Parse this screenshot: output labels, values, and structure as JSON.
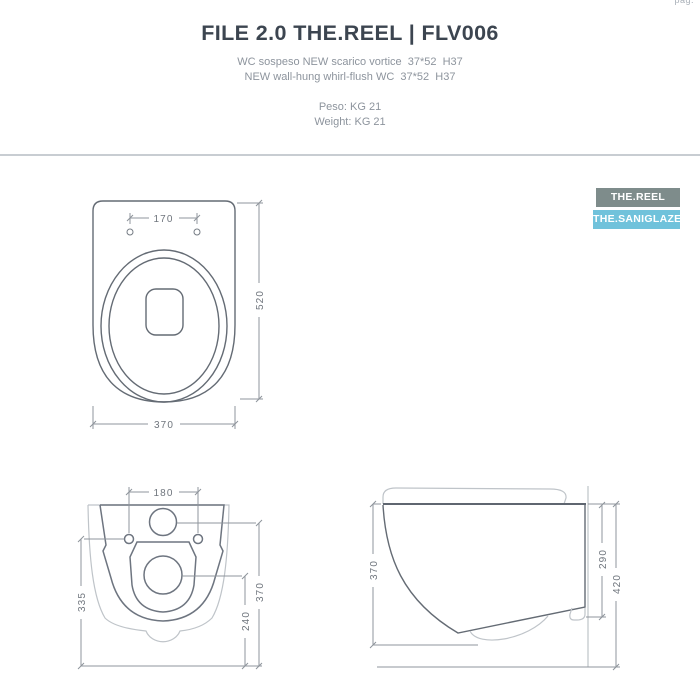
{
  "page": {
    "corner_label": "pag."
  },
  "header": {
    "title": "FILE 2.0 THE.REEL | FLV006",
    "description_lines": [
      "WC sospeso NEW scarico vortice  37*52  H37",
      "NEW wall-hung whirl-flush WC  37*52  H37"
    ],
    "weight_lines": [
      "Peso: KG 21",
      "Weight: KG 21"
    ]
  },
  "badges": [
    {
      "label": "THE.REEL",
      "color": "#7e8c8b"
    },
    {
      "label": "THE.SANIGLAZE",
      "color": "#70c2db"
    }
  ],
  "drawings": {
    "top_view": {
      "dim_hole_spacing": "170",
      "dim_depth": "520",
      "dim_width": "370"
    },
    "rear_view": {
      "dim_hole_spacing": "180",
      "dim_height_to_holes": "335",
      "dim_height_to_inlet": "370",
      "dim_height_to_drain": "240"
    },
    "side_view": {
      "dim_body_height": "370",
      "dim_outlet_height": "290",
      "dim_total_height": "420"
    }
  },
  "colors": {
    "title": "#3c4550",
    "subtitle": "#8d949d",
    "divider": "#c8cdd2",
    "line_dark": "#5f6670",
    "line_light": "#bfc4c9",
    "dimension": "#8f959c"
  }
}
